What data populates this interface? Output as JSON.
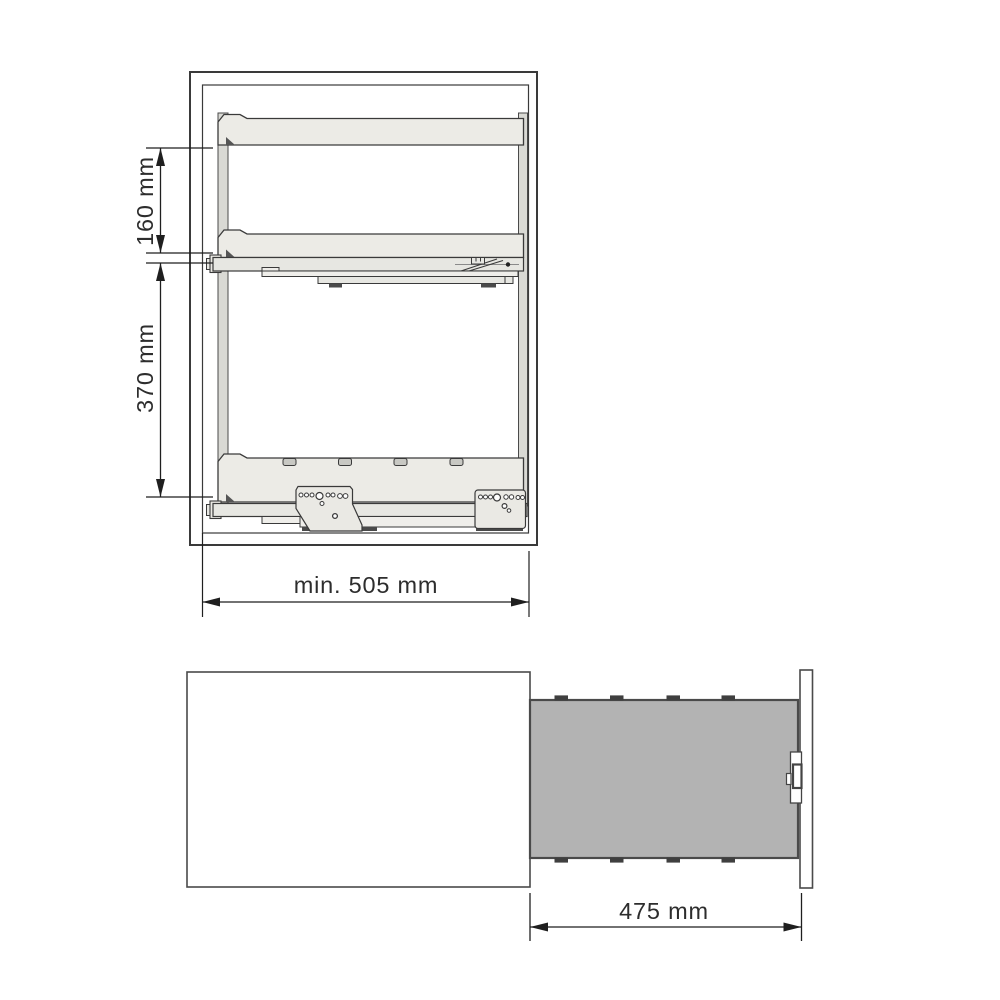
{
  "front_view": {
    "dim_top_spacing": "160 mm",
    "dim_bottom_spacing": "370 mm",
    "dim_min_width": "min. 505 mm"
  },
  "top_view": {
    "dim_extension": "475 mm"
  },
  "colors": {
    "pullout_fill": "#b3b3b3",
    "shelf_fill": "#ecebe6",
    "rail_fill": "#e7e7e2",
    "upright_fill": "#d9d9d4",
    "slot_fill": "#c8c8c3",
    "line": "#3a3a3a",
    "dim_line": "#1f1f1f"
  }
}
